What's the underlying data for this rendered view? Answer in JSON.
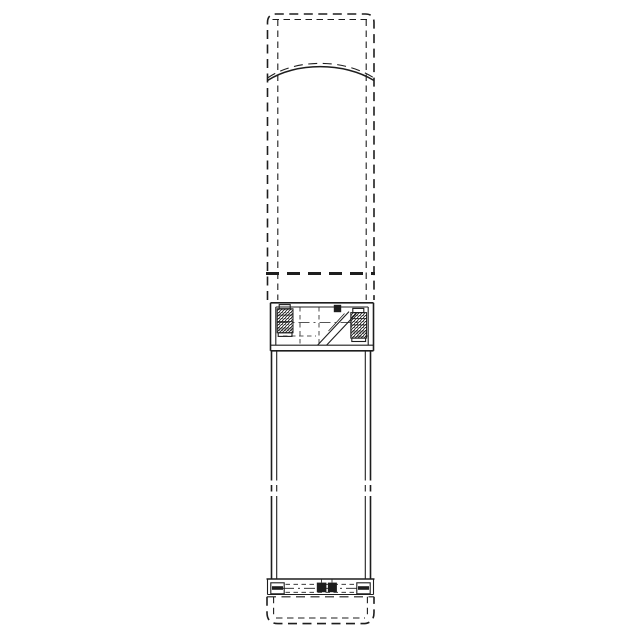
{
  "canvas": {
    "width_px": 640,
    "height_px": 640,
    "background_color": "#ffffff"
  },
  "drawing": {
    "stroke_color": "#1e1e1e",
    "style": "monochrome-technical-line-drawing",
    "view": "front-elevation",
    "parts": [
      "upper-housing-phantom-outline",
      "shoulder-arc",
      "phantom-break-line",
      "coupling-flange",
      "left-clamp-bolt",
      "right-clamp-bolt",
      "cable-guard",
      "cable-clamp-block",
      "coupling-center-line",
      "pump-sleeve-body",
      "sleeve-length-break-marks",
      "suction-interconnector-band",
      "left-foot-bracket",
      "right-foot-bracket",
      "cable-entry-blocks",
      "base-phantom-outline"
    ]
  }
}
